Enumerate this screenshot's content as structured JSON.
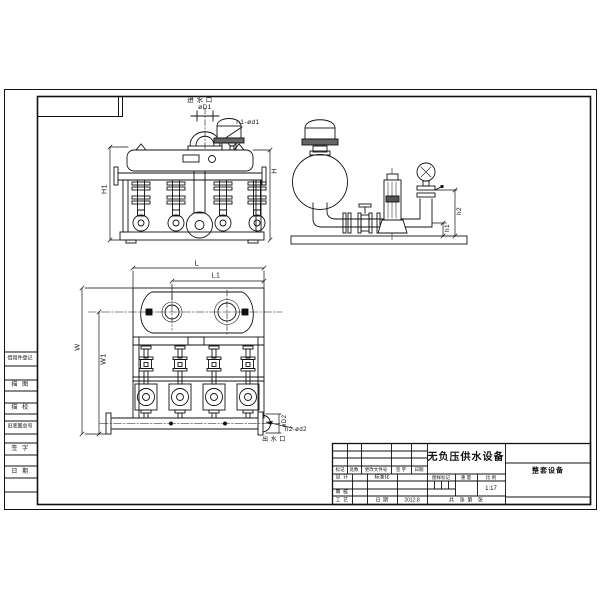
{
  "drawing": {
    "title": "无负压供水设备",
    "product": "整套设备",
    "scale_value": "1:17",
    "date_value": "2012.8"
  },
  "front_view": {
    "inlet_label": "进 水 口",
    "inlet_dia": "øD1",
    "inlet_bolts": "n1-ød1",
    "dim_h1": "H1",
    "dim_h": "H"
  },
  "side_view": {
    "dim_h1": "h1",
    "dim_h2": "h2"
  },
  "plan_view": {
    "dim_l": "L",
    "dim_l1": "L1",
    "dim_w": "W",
    "dim_w1": "W1",
    "outlet_dia": "øD2",
    "outlet_bolts": "n2-ød2",
    "outlet_label": "出 水 口"
  },
  "margin_column": {
    "items": [
      "借用件登记",
      "描  图",
      "描  校",
      "旧底图总号",
      "签  字",
      "日  期"
    ]
  },
  "title_block": {
    "revision_header": [
      "标记",
      "处数",
      "更改文件号",
      "签 字",
      "日期"
    ],
    "row_design": "设 计",
    "row_check": "审 核",
    "row_process": "工 艺",
    "standardization": "标准化",
    "date_label": "日 期",
    "date_value": "2012.8",
    "title": "无负压供水设备",
    "mark_label": "图样标记",
    "weight_label": "重 量",
    "scale_label": "比 例",
    "scale_value": "1:17",
    "sheet_label": "共    张  第    张",
    "product": "整套设备"
  }
}
